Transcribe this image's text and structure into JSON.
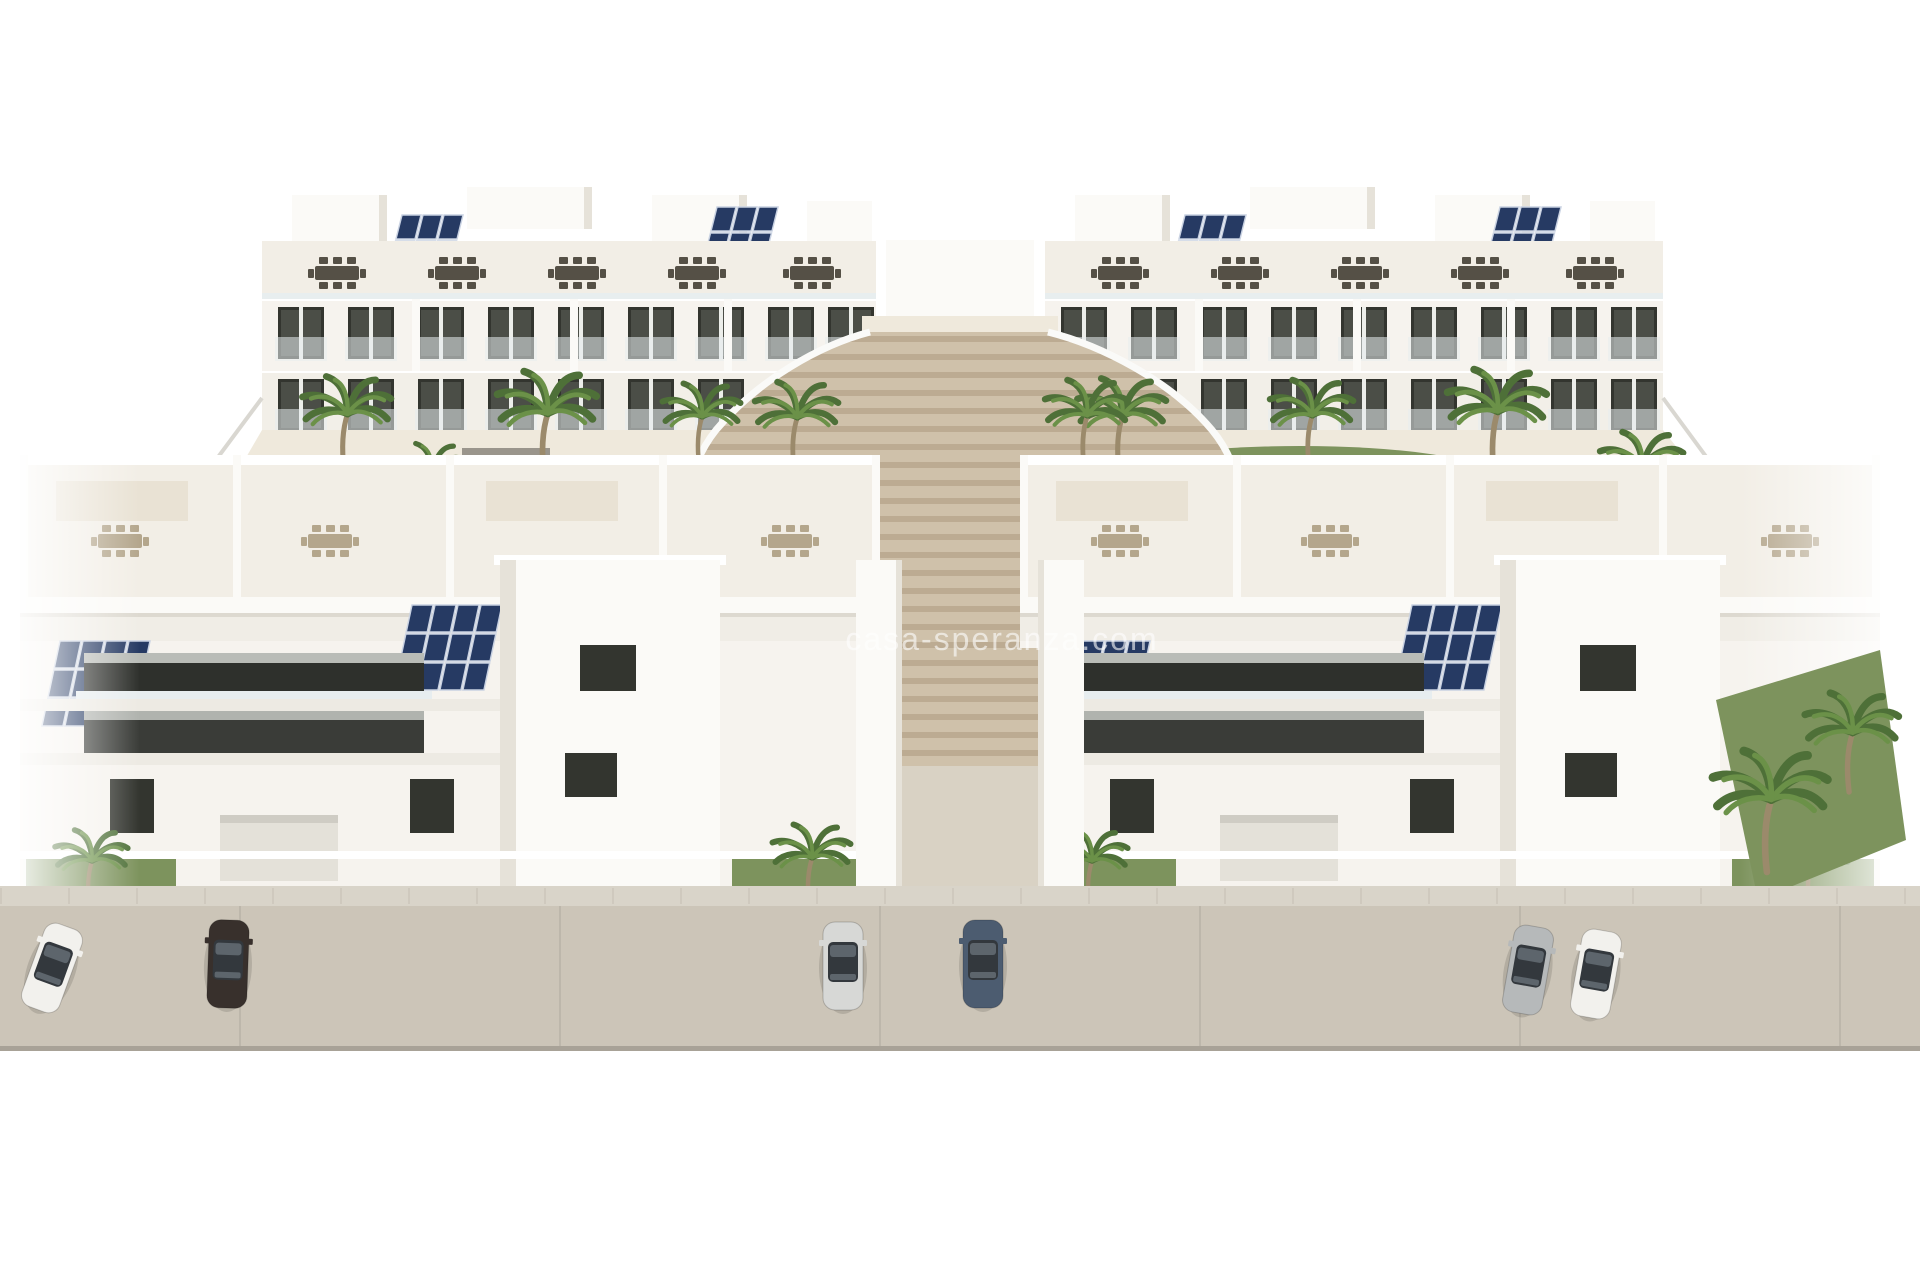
{
  "scene": {
    "type": "3d-architectural-render",
    "subject": "Aerial rendering of a new-build white residential complex: two rear apartment blocks and two front apartment blocks around a landscaped courtyard with a freeform pool, a rectangular lap pool, palm trees, a wide fan-shaped timber staircase in the centre, rooftop solariums with dining sets, pergolas and photovoltaic panels, and a street with parked cars in front",
    "watermark": "casa-speranza.com"
  },
  "colors": {
    "background": "#ffffff",
    "wall": "#f6f3ee",
    "wall_shade": "#e6e2d9",
    "roof_floor": "#f2eee6",
    "window_dark": "#33352f",
    "glass_rail": "#e7edef",
    "solar_panel": "#263a63",
    "solar_edge": "#c9d2e2",
    "green_lawn": "#7d935d",
    "green_dark": "#4e7038",
    "palm_light": "#6b9148",
    "trunk": "#9b8a6b",
    "sand_path": "#efe9dc",
    "stair_light": "#cfc1aa",
    "stair_dark": "#bcab92",
    "pool_free": "#5b82b4",
    "pool_rim": "#aed3ea",
    "pool_deep": "#41699b",
    "road": "#ccc5b8",
    "sidewalk": "#d9d4c9",
    "curb": "#a8a297",
    "furniture_dark": "#555046",
    "furniture_tan": "#b4a68c",
    "car_white": "#f2f1ed",
    "car_dark": "#38302c",
    "car_silver": "#d7d8d6",
    "car_blue": "#4c5c70",
    "car_gray": "#b6b9ba"
  },
  "objects": {
    "back_buildings": [
      {
        "name": "back-left-block",
        "floors": 3,
        "features": [
          "rooftop terraces with dark dining sets",
          "solar panel arrays",
          "glass balcony rails",
          "dark glazed openings"
        ]
      },
      {
        "name": "back-right-block",
        "floors": 3,
        "features": [
          "rooftop terraces with dark dining sets",
          "solar panel arrays",
          "glass balcony rails",
          "dark glazed openings"
        ]
      }
    ],
    "front_buildings": [
      {
        "name": "front-left-block",
        "floors": 3,
        "features": [
          "rooftop solarium with tan dining sets and pergolas",
          "solar panel arrays",
          "recessed dark balconies",
          "garages and fenced front yards"
        ]
      },
      {
        "name": "front-right-block",
        "floors": 3,
        "features": [
          "rooftop solarium with tan dining sets and pergolas",
          "solar panel arrays",
          "recessed dark balconies",
          "garages and fenced front yards"
        ]
      }
    ],
    "pools": [
      {
        "name": "freeform-pool",
        "shape": "kidney",
        "loungers": 3
      },
      {
        "name": "lap-pool",
        "shape": "rectangular",
        "loungers": 6
      }
    ],
    "central_staircase": {
      "shape": "fan",
      "material": "timber-toned steps",
      "leads_to": "street-level walkway between front blocks"
    },
    "palm_trees_estimate": 24,
    "street": {
      "sidewalk": "paved slabs",
      "parked_cars": [
        {
          "color": "white",
          "position": "far-left"
        },
        {
          "color": "dark-brown",
          "position": "left"
        },
        {
          "color": "silver",
          "position": "centre-left"
        },
        {
          "color": "dark-blue",
          "position": "centre-right"
        },
        {
          "color": "silver-gray",
          "position": "right-pair-outer"
        },
        {
          "color": "white-dark-roof",
          "position": "right-pair-inner"
        }
      ]
    }
  }
}
